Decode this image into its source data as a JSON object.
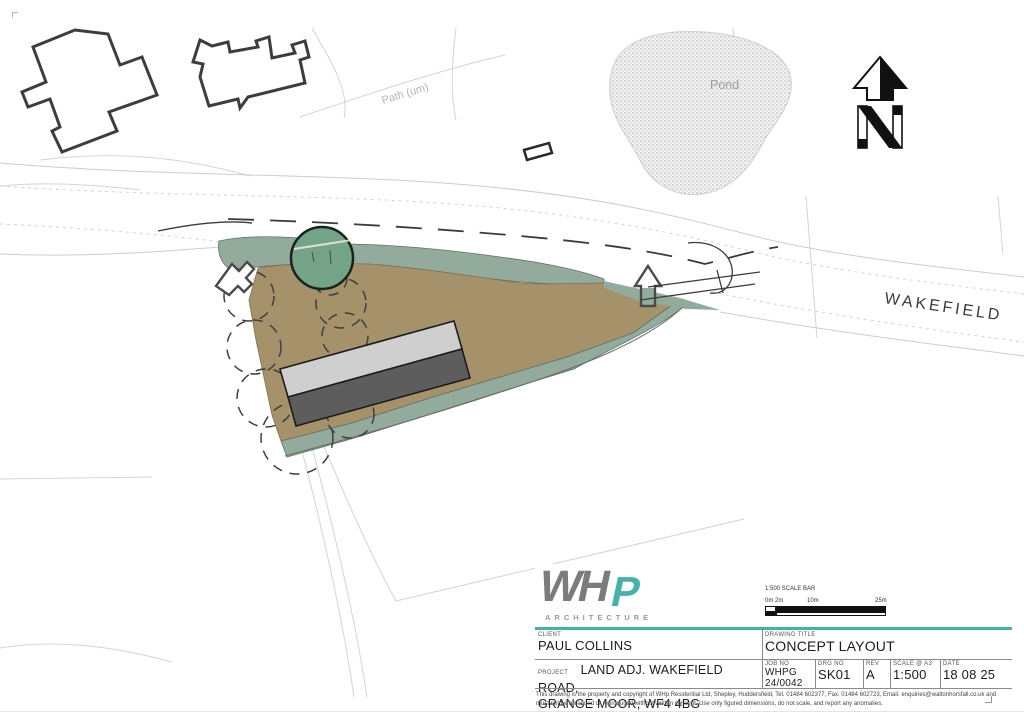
{
  "map": {
    "labels": {
      "path": "Path (um)",
      "pond": "Pond",
      "road": "WAKEFIELD",
      "north": "N"
    },
    "colors": {
      "teal": "#45b2a8",
      "site_brown": "#a6926a",
      "band_sage": "#93ab9c",
      "tree_green": "#74a387",
      "roof_light": "#cfcfcf",
      "roof_dark": "#5d5d5d",
      "outline_dark": "#3d3d3d"
    }
  },
  "title_block": {
    "logo": {
      "wh": "WH",
      "p": "P",
      "subtitle": "ARCHITECTURE"
    },
    "scale_bar": {
      "title": "1:500 SCALE BAR",
      "tick0": "0m 2m",
      "tick10": "10m",
      "tick25": "25m"
    },
    "fields": {
      "client_label": "CLIENT",
      "client": "PAUL COLLINS",
      "drawing_title_label": "DRAWING TITLE",
      "drawing_title": "CONCEPT LAYOUT",
      "project_label": "PROJECT",
      "project_line1": "LAND ADJ. WAKEFIELD ROAD,",
      "project_line2": "GRANGE MOOR, WF4 4BG",
      "job_no_label": "JOB NO",
      "job_no_line1": "WHPG",
      "job_no_line2": "24/0042",
      "drg_no_label": "DRG NO",
      "drg_no": "SK01",
      "rev_label": "REV",
      "rev": "A",
      "scale_label": "SCALE @ A3",
      "scale": "1:500",
      "date_label": "DATE",
      "date": "18 08 25"
    },
    "disclaimer": "This drawing is the property and copyright of WHp Residential Ltd, Shepley, Huddersfield, Tel. 01484 602377, Fax. 01484 602723, Email. enquiries@waltonhorsfall.co.uk and must not be amended or reproduced without written consent. Use only figured dimensions, do not scale, and report any anomalies."
  }
}
